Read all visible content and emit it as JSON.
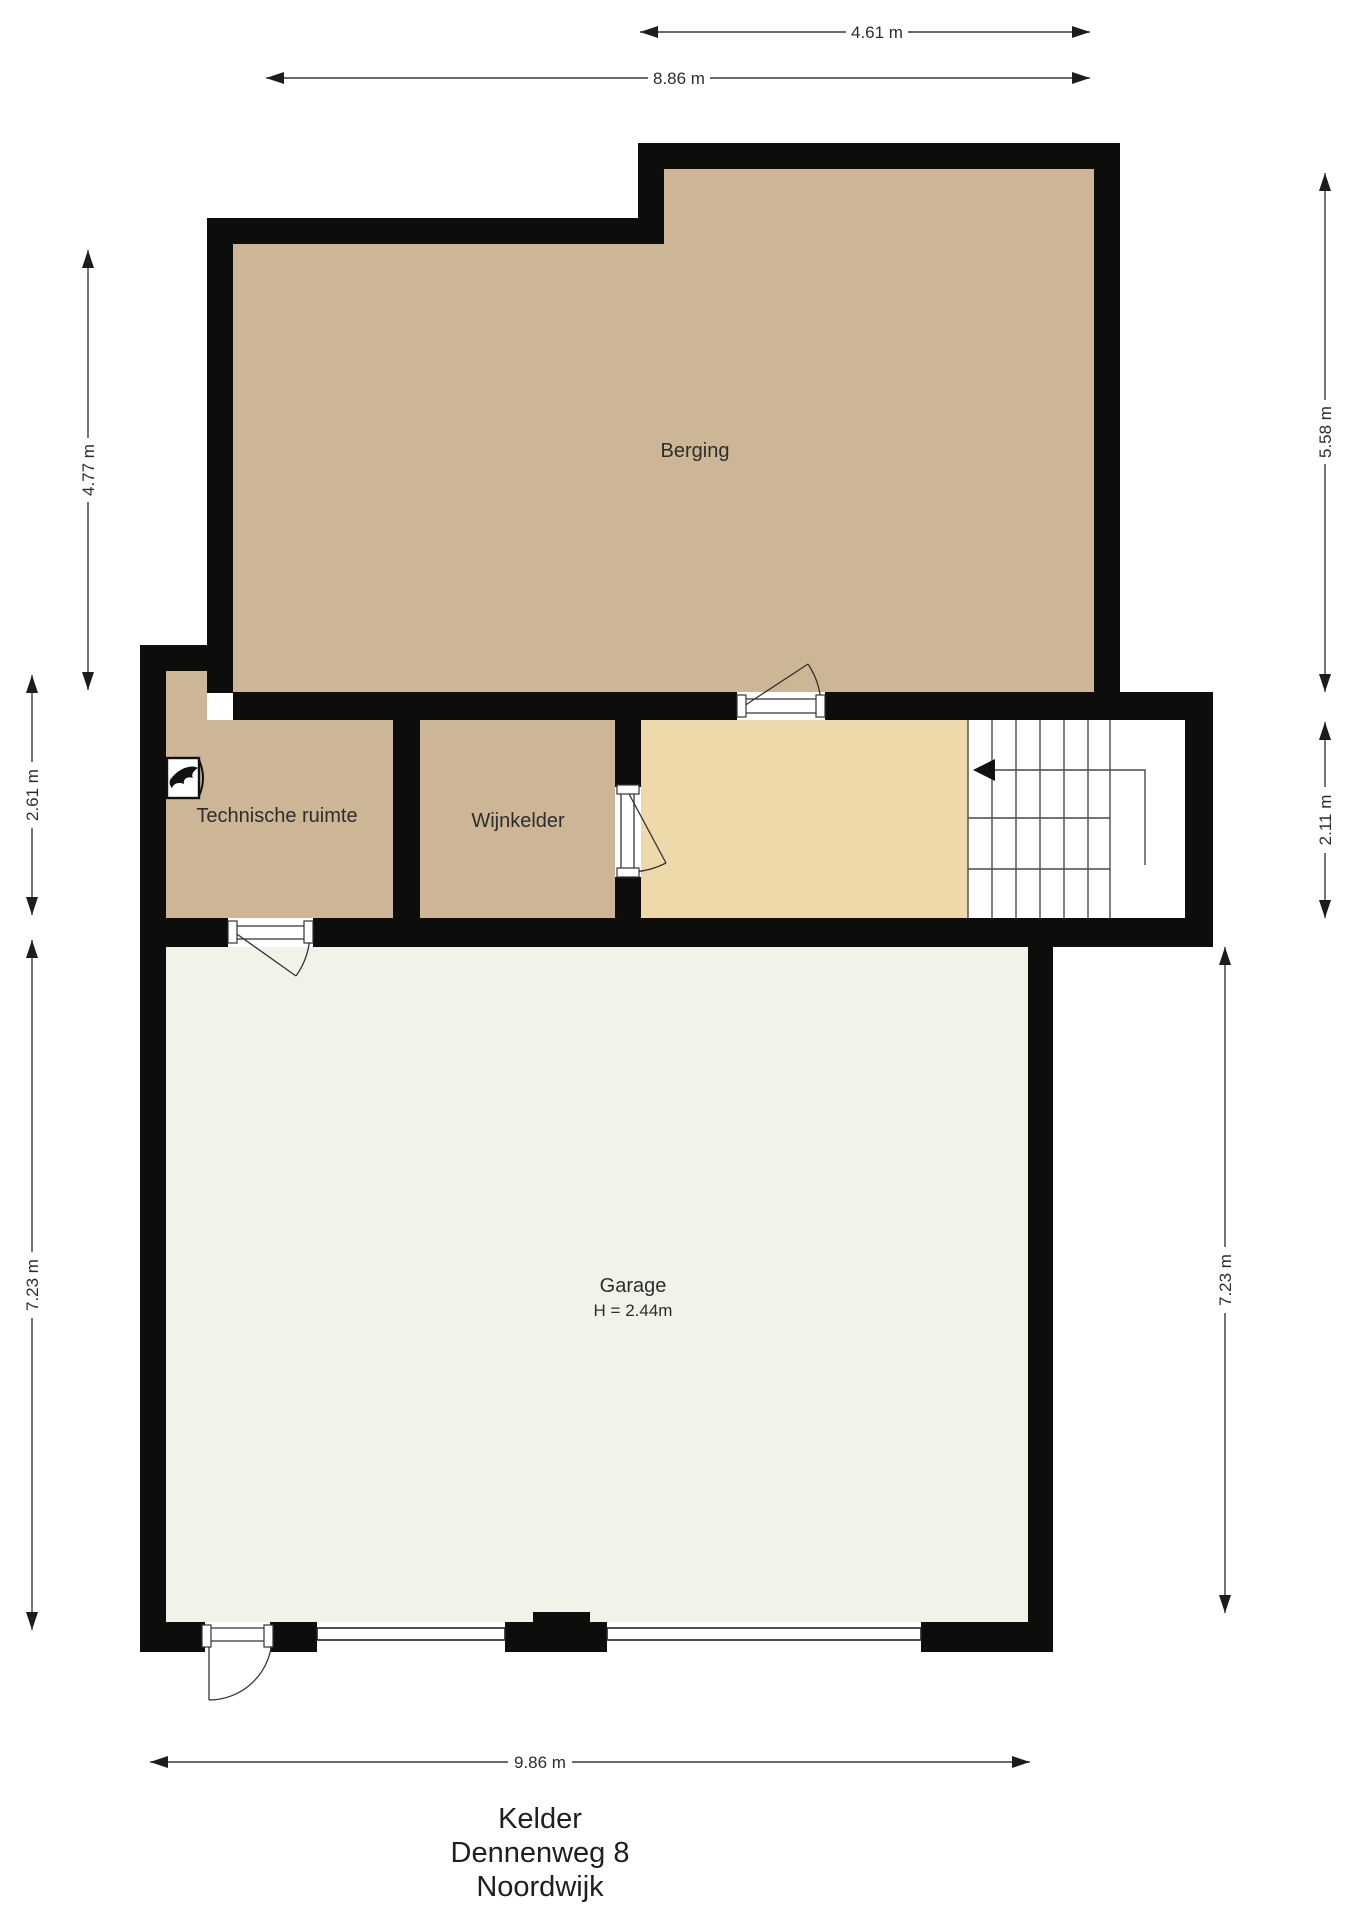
{
  "title": {
    "floor": "Kelder",
    "street": "Dennenweg 8",
    "city": "Noordwijk"
  },
  "rooms": {
    "berging": {
      "name": "Berging"
    },
    "technische": {
      "name": "Technische ruimte"
    },
    "wijnkelder": {
      "name": "Wijnkelder"
    },
    "garage": {
      "name": "Garage",
      "height_note": "H = 2.44m"
    }
  },
  "dimensions": {
    "top_inner": "4.61 m",
    "top_outer": "8.86 m",
    "left_top": "4.77 m",
    "left_mid": "2.61 m",
    "left_bottom": "7.23 m",
    "right_top": "5.58 m",
    "right_mid": "2.11 m",
    "right_bottom": "7.23 m",
    "bottom": "9.86 m"
  },
  "icons": {
    "stairs_arrow": "stairs-up-direction-arrow",
    "boiler": "boiler-unit"
  },
  "colors": {
    "wall": "#0d0d0c",
    "room_tan": "#cdb695",
    "hall_beige": "#eed9ab",
    "garage_cream": "#f3f2e9",
    "line": "#3a3a3a",
    "text": "#2d2d2d"
  }
}
